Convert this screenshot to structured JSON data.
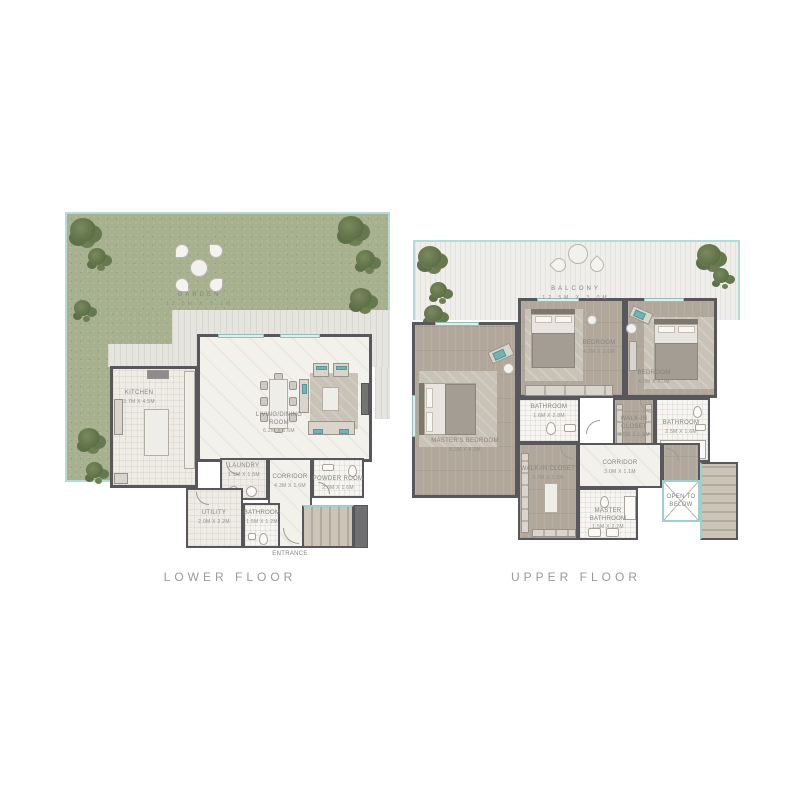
{
  "palette": {
    "garden_green": "#a7b18f",
    "teal_accent": "#74b3b2",
    "wall_gray": "#58585c",
    "wood_floor": "#b1a79b",
    "deck_gray": "#e6e4de",
    "balcony_white": "#efeeea",
    "label_gray": "#84847e"
  },
  "plans": {
    "lower": {
      "title": "LOWER FLOOR",
      "garden": {
        "label": "GARDEN",
        "dims": "12.5M X 7.1M"
      },
      "kitchen": {
        "label": "KITCHEN",
        "dims": "3.7M X 4.5M"
      },
      "living": {
        "label": "LIVING/DINING ROOM",
        "dims": "6.2M X 5.6M"
      },
      "laundry": {
        "label": "LAUNDRY",
        "dims": "1.5M X 1.5M"
      },
      "corridor": {
        "label": "CORRIDOR",
        "dims": "4.3M X 1.6M"
      },
      "powder": {
        "label": "POWDER ROOM",
        "dims": "2.6M X 1.6M"
      },
      "utility": {
        "label": "UTILITY",
        "dims": "2.0M X 2.2M"
      },
      "bathroom": {
        "label": "BATHROOM",
        "dims": "1.5M X 1.2M"
      },
      "entrance": {
        "label": "ENTRANCE",
        "dims": ""
      }
    },
    "upper": {
      "title": "UPPER FLOOR",
      "balcony": {
        "label": "BALCONY",
        "dims": "12.5M X 3.0M"
      },
      "master": {
        "label": "MASTER'S BEDROOM",
        "dims": "5.3M X 4.2M"
      },
      "bedroom2": {
        "label": "BEDROOM",
        "dims": "4.2M X 3.6M"
      },
      "bedroom3": {
        "label": "BEDROOM",
        "dims": "4.0M X 4.0M"
      },
      "bath2": {
        "label": "BATHROOM",
        "dims": "1.6M X 2.8M"
      },
      "wic2": {
        "label": "WALK-IN CLOSET",
        "dims": "2.5M X 1.5M"
      },
      "bath3": {
        "label": "BATHROOM",
        "dims": "2.5M X 1.6M"
      },
      "wic1": {
        "label": "WALK-IN CLOSET",
        "dims": "3.7M X 2.2M"
      },
      "corridor": {
        "label": "CORRIDOR",
        "dims": "3.0M X 1.1M"
      },
      "masterbath": {
        "label": "MASTER BATHROOM",
        "dims": "1.5M X 2.2M"
      },
      "openbelow": {
        "label": "OPEN TO BELOW",
        "dims": ""
      }
    }
  }
}
